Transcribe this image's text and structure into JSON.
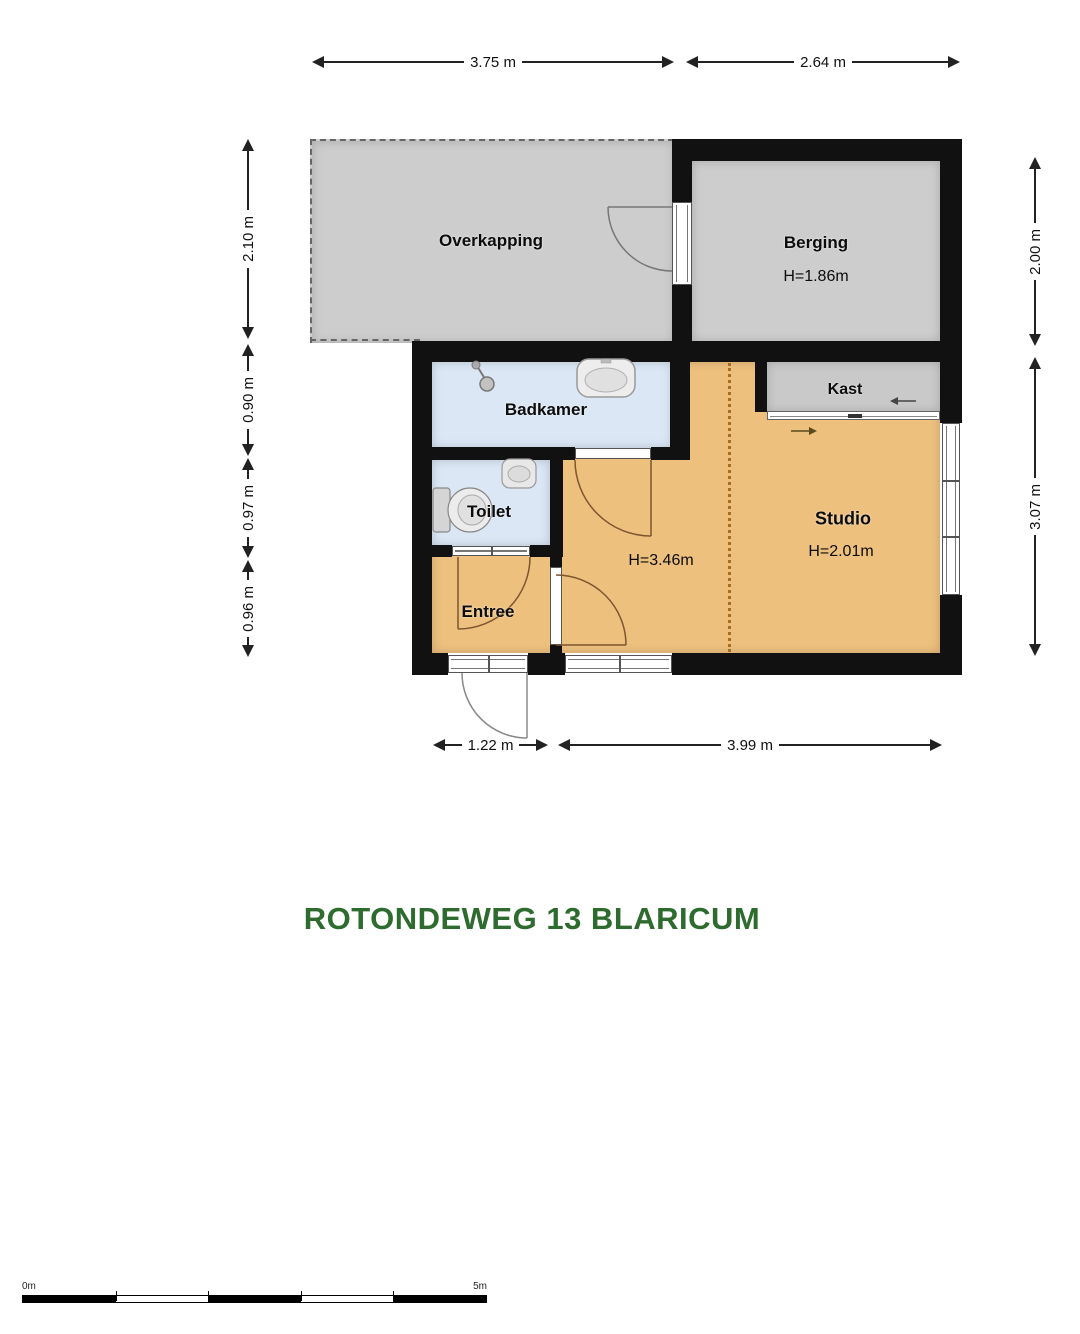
{
  "title": "ROTONDEWEG 13 BLARICUM",
  "rooms": {
    "overkapping": {
      "name": "Overkapping"
    },
    "berging": {
      "name": "Berging",
      "height": "H=1.86m"
    },
    "badkamer": {
      "name": "Badkamer"
    },
    "toilet": {
      "name": "Toilet"
    },
    "entree": {
      "name": "Entree"
    },
    "studio": {
      "name": "Studio",
      "height": "H=2.01m",
      "height_left_zone": "H=3.46m"
    },
    "kast": {
      "name": "Kast"
    }
  },
  "dimensions": {
    "top": [
      {
        "label": "3.75 m"
      },
      {
        "label": "2.64 m"
      }
    ],
    "bottom": [
      {
        "label": "1.22 m"
      },
      {
        "label": "3.99 m"
      }
    ],
    "left": [
      {
        "label": "2.10 m"
      },
      {
        "label": "0.90 m"
      },
      {
        "label": "0.97 m"
      },
      {
        "label": "0.96 m"
      }
    ],
    "right": [
      {
        "label": "2.00 m"
      },
      {
        "label": "3.07 m"
      }
    ]
  },
  "scale_bar": {
    "start": "0m",
    "end": "5m"
  },
  "icons": [
    "shower-icon",
    "sink-icon",
    "corner-sink-icon",
    "toilet-icon",
    "door-swing-arc",
    "sliding-door-arrow-left",
    "sliding-door-arrow-right"
  ],
  "colors": {
    "floor_orange": "#eec07e",
    "floor_blue": "#dbe7f5",
    "floor_gray": "#cdcdcd",
    "kast_gray": "#c9c9c9",
    "wall_black": "#111111",
    "title_green": "#2e6b2e",
    "divider_brown": "#a96d22",
    "dimension_ink": "#222222"
  }
}
